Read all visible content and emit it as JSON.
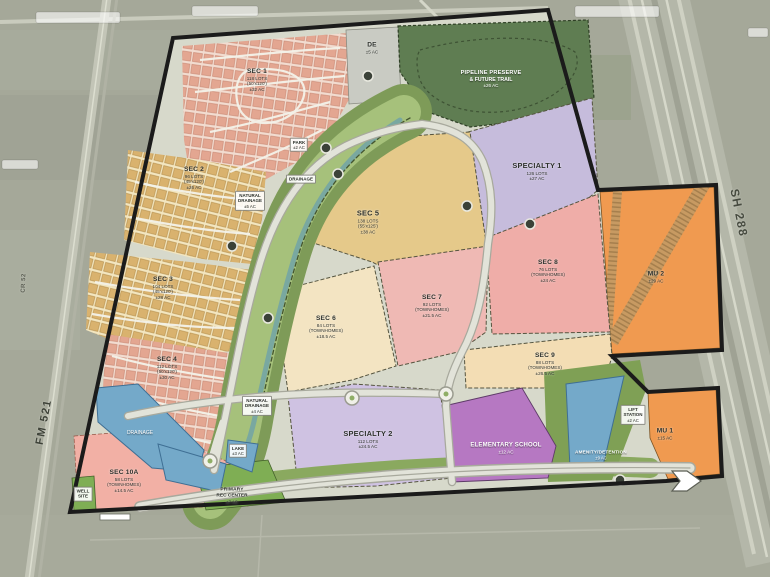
{
  "title": "Master planned community land plan",
  "roads": {
    "fm521": "FM 521",
    "sh288": "SH 288",
    "cr52": "CR 52"
  },
  "parcels": {
    "sec1": {
      "title": "SEC 1",
      "l1": "118 LOTS",
      "l2": "(50'x120')",
      "l3": "±32 AC"
    },
    "sec2": {
      "title": "SEC 2",
      "l1": "96 LOTS",
      "l2": "(45'x120')",
      "l3": "±26 AC"
    },
    "sec3": {
      "title": "SEC 3",
      "l1": "104 LOTS",
      "l2": "(45'x120')",
      "l3": "±28 AC"
    },
    "sec4": {
      "title": "SEC 4",
      "l1": "112 LOTS",
      "l2": "(50'x120')",
      "l3": "±30 AC"
    },
    "sec5": {
      "title": "SEC 5",
      "l1": "138 LOTS",
      "l2": "(55'x125')",
      "l3": "±38 AC"
    },
    "sec6": {
      "title": "SEC 6",
      "l1": "84 LOTS",
      "l2": "(TOWNHOMES)",
      "l3": "±18.5 AC"
    },
    "sec7": {
      "title": "SEC 7",
      "l1": "92 LOTS",
      "l2": "(TOWNHOMES)",
      "l3": "±21.5 AC"
    },
    "sec8": {
      "title": "SEC 8",
      "l1": "76 LOTS",
      "l2": "(TOWNHOMES)",
      "l3": "±24 AC"
    },
    "sec9": {
      "title": "SEC 9",
      "l1": "88 LOTS",
      "l2": "(TOWNHOMES)",
      "l3": "±26.5 AC"
    },
    "sec10a": {
      "title": "SEC 10A",
      "l1": "58 LOTS",
      "l2": "(TOWNHOMES)",
      "l3": "±14.5 AC"
    },
    "spec1": {
      "title": "SPECIALTY 1",
      "l1": "126 LOTS",
      "l2": "±27 AC"
    },
    "spec2": {
      "title": "SPECIALTY 2",
      "l1": "112 LOTS",
      "l2": "±24.5 AC"
    },
    "school": {
      "title": "ELEMENTARY SCHOOL",
      "l1": "±12 AC"
    },
    "amenity": {
      "title": "AMENITY/DETENTION",
      "l1": "±9 AC"
    },
    "lift": {
      "l1": "LIFT",
      "l2": "STATION",
      "l3": "±2 AC"
    },
    "mu1": {
      "title": "MU 1",
      "l1": "±15 AC"
    },
    "mu2": {
      "title": "MU 2",
      "l1": "±29 AC"
    },
    "preserve": {
      "l1": "PIPELINE PRESERVE",
      "l2": "& FUTURE TRAIL",
      "l3": "±26 AC"
    },
    "de": {
      "title": "DE",
      "l1": "±5 AC"
    },
    "park": {
      "l1": "PARK",
      "l2": "±2 AC"
    },
    "drainage_corridor": {
      "l1": "DRAINAGE"
    },
    "natdrain1": {
      "l1": "NATURAL",
      "l2": "DRAINAGE",
      "l3": "±5 AC"
    },
    "natdrain2": {
      "l1": "NATURAL",
      "l2": "DRAINAGE",
      "l3": "±4 AC"
    },
    "lake": {
      "l1": "LAKE",
      "l2": "±3 AC"
    },
    "lake_drainage": {
      "l1": "DRAINAGE"
    },
    "rec": {
      "l1": "PRIMARY",
      "l2": "REC CENTER",
      "l3": "±7 AC"
    },
    "well": {
      "l1": "WELL",
      "l2": "SITE"
    }
  },
  "colors": {
    "boundary": "#1b1b1b",
    "single_family_pink": "#e3a691",
    "single_family_tan": "#d9b26e",
    "sec5_yellow": "#e5c98a",
    "townhome_pink": "#efadа8",
    "cream": "#f3ddb4",
    "specialty_lavender": "#c9bedd",
    "school_purple": "#b678c2",
    "mixed_use_orange": "#f09a50",
    "preserve_green": "#5f7d52",
    "greenway_green": "#7e9b58",
    "lake_blue": "#74a9c9",
    "aerial_gray": "#a5a899"
  }
}
